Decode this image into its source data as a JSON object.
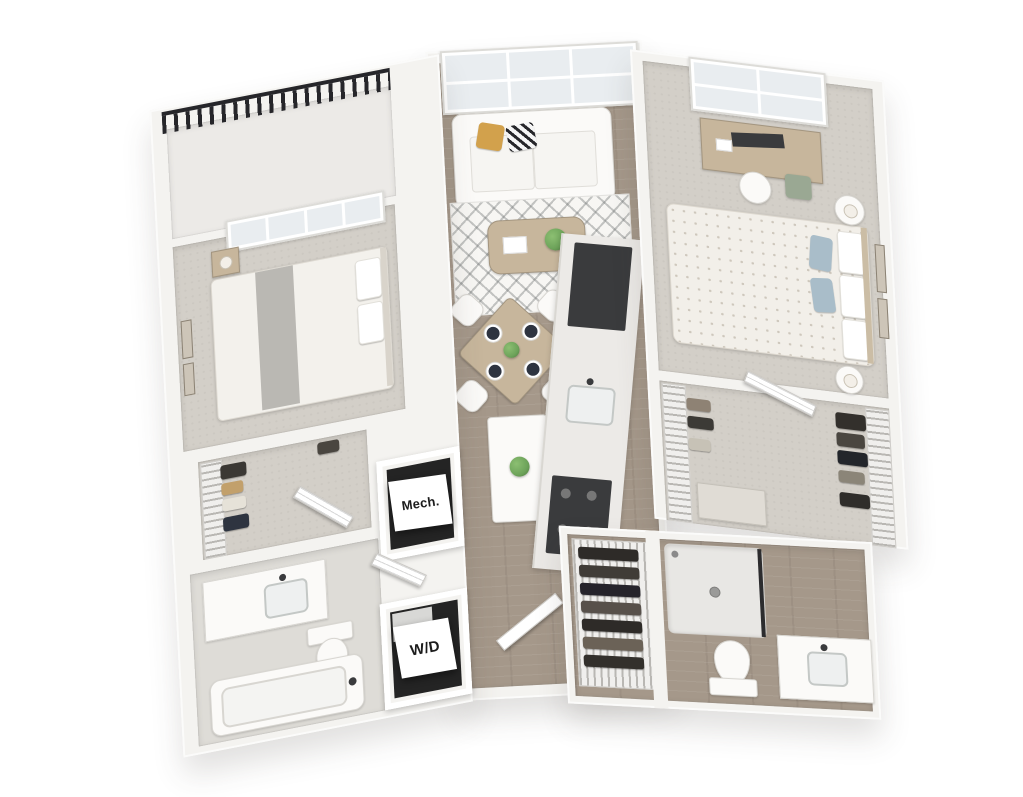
{
  "labels": {
    "mech_closet": "Mech.",
    "washer_dryer": "W/D"
  },
  "colors": {
    "background": "#ffffff",
    "wall": "#f4f3f0",
    "wall_shade": "#dbd9d4",
    "wood_floor": "#a5988a",
    "carpet": "#d3cfc8",
    "tile": "#dedcd7",
    "railing": "#26262a",
    "glass": "#e9edf0",
    "appliance_dark": "#3a3b3d",
    "wood_furniture": "#c7b69c",
    "accent_pillow": "#d2a14c",
    "plant": "#6da35a",
    "blue_pillow": "#a9bdc9",
    "clothes_dark": "#3b3834"
  }
}
